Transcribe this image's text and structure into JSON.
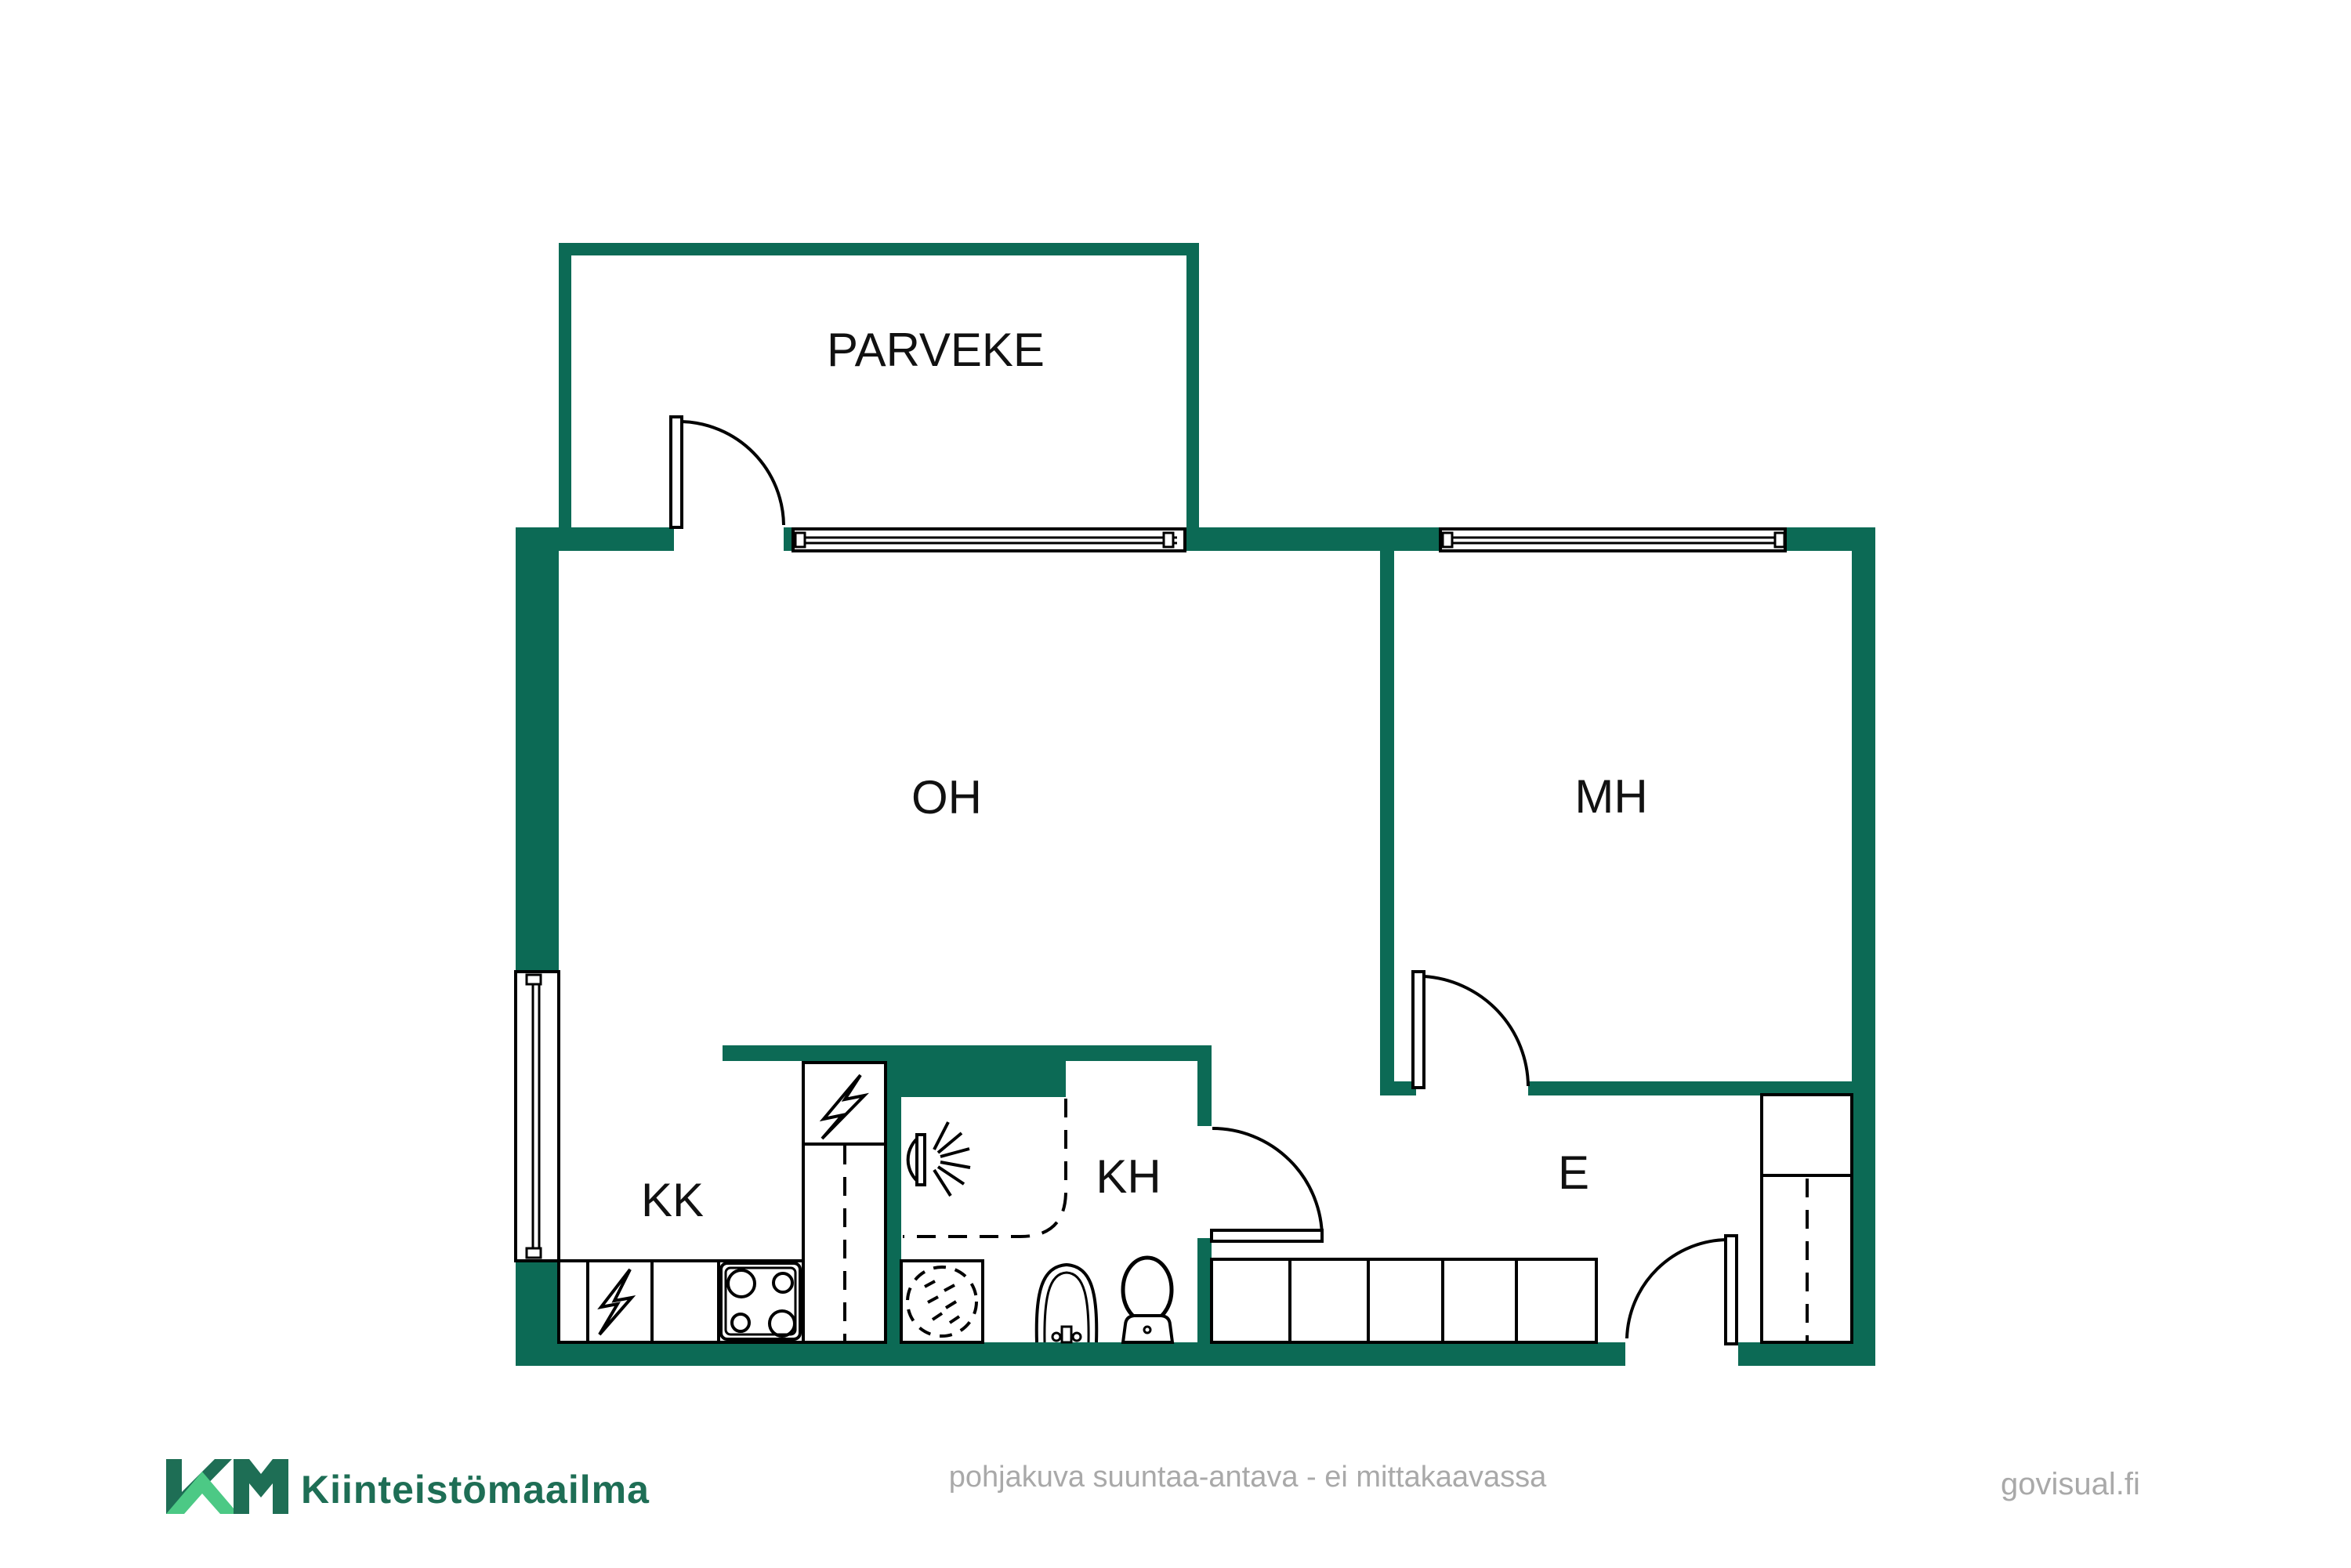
{
  "colors": {
    "wall": "#0c6a55",
    "line": "#000000",
    "label": "#111111",
    "logo_dark": "#1e6e55",
    "logo_light": "#4cc985",
    "muted_text": "#a9a9a9",
    "background": "#ffffff"
  },
  "rooms": {
    "balcony": "PARVEKE",
    "living_room": "OH",
    "bedroom": "MH",
    "kitchenette": "KK",
    "bathroom": "KH",
    "entry": "E"
  },
  "icons": {
    "stove": "stove-burners-icon",
    "electric_appliance": "lightning-icon",
    "refrigerator": "lightning-icon",
    "washing_machine": "washing-machine-icon",
    "shower": "shower-icon",
    "sink": "sink-icon",
    "toilet": "toilet-icon",
    "closet": "closet-icon",
    "wardrobe": "wardrobe-icon",
    "window": "window-icon",
    "door": "door-arc-icon"
  },
  "footer": {
    "brand": "Kiinteistömaailma",
    "disclaimer": "pohjakuva suuntaa-antava - ei mittakaavassa",
    "watermark": "govisual.fi"
  }
}
